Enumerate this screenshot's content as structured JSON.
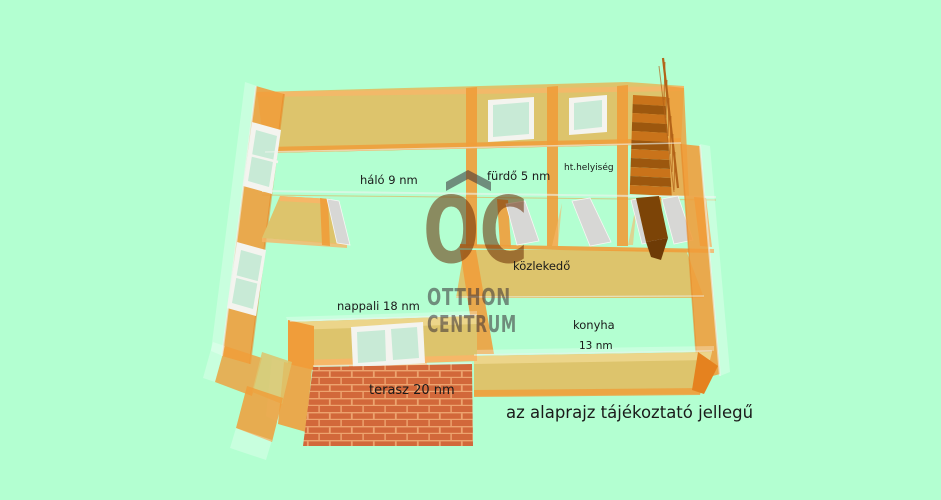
{
  "plan": {
    "rooms": {
      "halo": {
        "label": "háló 9 nm"
      },
      "furdo": {
        "label": "fürdő 5 nm"
      },
      "ht_helyiseg": {
        "label": "ht.helyiség"
      },
      "kozlekedo": {
        "label": "közlekedő"
      },
      "nappali": {
        "label": "nappali 18 nm"
      },
      "konyha": {
        "label": "konyha",
        "size": "13 nm"
      },
      "terasz": {
        "label": "terasz 20 nm"
      }
    },
    "disclaimer": "az alaprajz tájékoztató jellegű"
  },
  "watermark": {
    "monogram": "OC",
    "line1": "OTTHON",
    "line2": "CENTRUM",
    "roof_icon": "house-roof-icon"
  },
  "colors": {
    "bg": "#b3ffd1",
    "tan": "#ddc46c",
    "tan-light": "#ecd58a",
    "orange": "#f09d3a",
    "orange-soft": "#f6b768",
    "orange-deep": "#e5821f",
    "glass": "#c8ead6",
    "frame": "#f4f4ef",
    "door": "#d7d7d5",
    "stair-a": "#c9731a",
    "stair-b": "#9c570e",
    "stair-dark": "#7c4407",
    "brick": "#d2683a",
    "mortar": "#eda36e",
    "wm-gray": "rgba(55,48,54,0.55)",
    "wm-olive": "rgba(104,44,4,0.55)",
    "ink": "#1a1a1a"
  }
}
